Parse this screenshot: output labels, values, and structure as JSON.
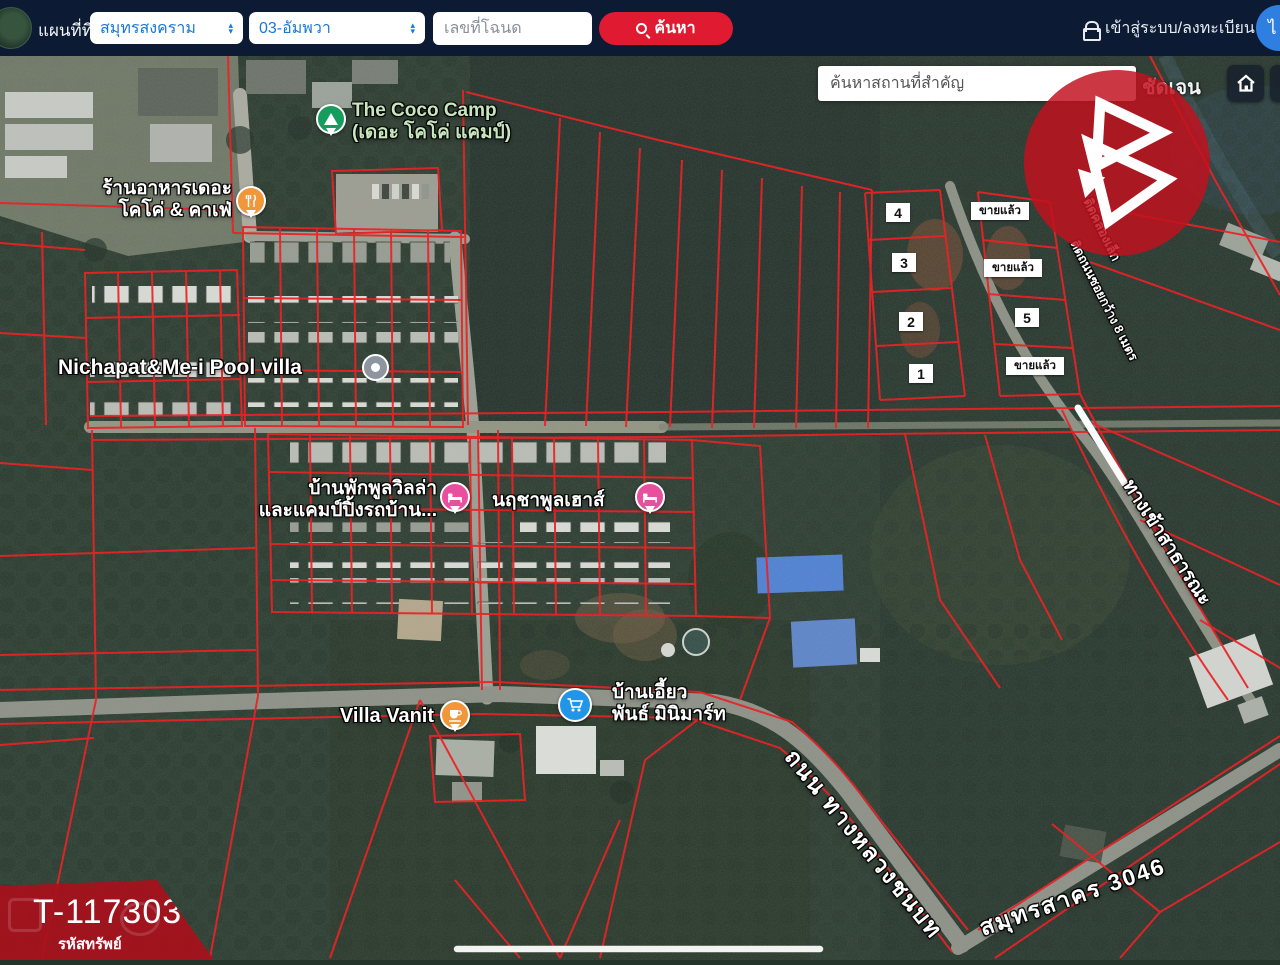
{
  "header": {
    "app_title": "แผนที่ที่ดิน",
    "province_select": "สมุทรสงคราม",
    "district_select": "03-อัมพวา",
    "deed_placeholder": "เลขที่โฉนด",
    "search_button": "ค้นหา",
    "login_label": "เข้าสู่ระบบ/ลงทะเบียน",
    "lang_label": "ไ"
  },
  "map_toolbar": {
    "search_placeholder": "ค้นหาสถานที่สำคัญ",
    "clear_button": "ชัดเจน",
    "layers_glyph": "▤"
  },
  "map_labels": {
    "coco_camp_line1": "The Coco Camp",
    "coco_camp_line2": "(เดอะ โคโค่ แคมป์)",
    "restaurant_line1": "ร้านอาหารเดอะ",
    "restaurant_line2": "โคโค่ & คาเฟ่",
    "nichapat": "Nichapat&Me-i Pool villa",
    "baanpak_line1": "บ้านพักพูลวิลล่า",
    "baanpak_line2": "และแคมป์ปิ้งรถบ้าน...",
    "narucha": "นฤชาพูลเฮาส์",
    "villa_vanit": "Villa Vanit",
    "baan_eaw_line1": "บ้านเอี้ยว",
    "baan_eaw_line2": "พันธ์ มินิมาร์ท",
    "road_line1": "ถนน ทางหลวงชนบท",
    "road_line2": "สมุทรสาคร 3046",
    "access_road": "ทางเข้าสาธารณะ",
    "soi_note": "ติดถนนซอยกว้าง 8 เมตร",
    "canal_note": "ติดคลองเล็ก"
  },
  "parcels": {
    "sold_label": "ขายแล้ว",
    "numbers": [
      "1",
      "2",
      "3",
      "4",
      "5"
    ]
  },
  "property_badge": {
    "code": "T-117303",
    "label": "รหัสทรัพย์"
  },
  "icons": {
    "search": "magnifier",
    "lock": "padlock",
    "sort": "dual-arrows",
    "home": "house",
    "layers": "layers-grid",
    "camp": "tent",
    "restaurant": "fork-knife",
    "generic_poi": "grey-dot",
    "lodging": "bed",
    "cafe": "cup",
    "store": "shopping-cart",
    "watermark": "triangle-b-logo"
  },
  "colors": {
    "header_bg": "#0c1b33",
    "accent_red": "#e01b31",
    "parcel_line": "#ee1318",
    "watermark_red": "#c1111e",
    "banner_red": "#a8101c",
    "poi_green": "#169c5c",
    "poi_orange": "#f0973a",
    "poi_pink": "#e84f9e",
    "poi_blue": "#2196e8",
    "select_text": "#1878d8"
  }
}
